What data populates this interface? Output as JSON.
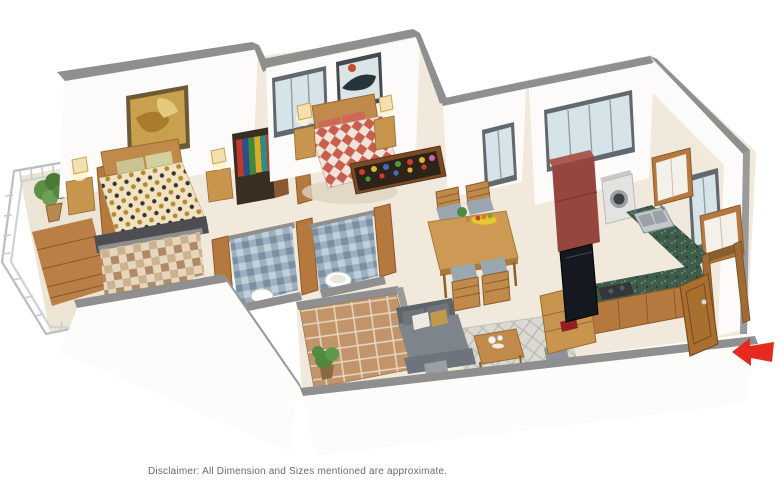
{
  "image": {
    "kind": "3d-isometric-floor-plan-render",
    "background": "#ffffff"
  },
  "disclaimer": {
    "text": "Disclaimer: All Dimension and Sizes mentioned are approximate."
  },
  "entrance_arrow": {
    "direction": "left",
    "color": "#e62b1e"
  },
  "palette": {
    "wall_cap": "#8f8f8f",
    "wall_face": "#fcfbf9",
    "floor": "#f1eadc",
    "wood": "#b5793f",
    "wood_light": "#c8954f",
    "granite_green": "#3f5c4b",
    "fridge_maroon": "#96463e",
    "sofa_gray": "#7e848c",
    "tile_blue": "#8ea2b5",
    "tile_brown": "#b08a64",
    "balcony_tile": "#c2946a",
    "window_glass": "#d6e4e9",
    "duvet_gold": "#b68a2c",
    "duvet_red": "#c75f4e"
  },
  "rooms": [
    {
      "id": "bedroom-1",
      "label": "Bedroom",
      "items": [
        "double bed",
        "2 nightstands",
        "2 table lamps",
        "wall art",
        "open wardrobe with clothes",
        "balcony door"
      ]
    },
    {
      "id": "master-bedroom",
      "label": "Master Bedroom",
      "items": [
        "double bed",
        "2 nightstands",
        "2 table lamps",
        "wall art",
        "window",
        "display shelf with bottles"
      ]
    },
    {
      "id": "balcony-left",
      "label": "Balcony",
      "items": [
        "metal railing",
        "potted plant",
        "wooden deck"
      ]
    },
    {
      "id": "bathroom-1",
      "label": "Bathroom",
      "items": [
        "brown checker tiled wall",
        "toilet",
        "wooden door"
      ]
    },
    {
      "id": "bathroom-2",
      "label": "Bathroom",
      "items": [
        "blue checker tiled wall",
        "toilet",
        "wooden door"
      ]
    },
    {
      "id": "bathroom-3",
      "label": "Bathroom",
      "items": [
        "blue checker tiled wall",
        "toilet",
        "wooden door"
      ]
    },
    {
      "id": "dining-area",
      "label": "Dining",
      "items": [
        "wooden dining table",
        "4 chairs",
        "fruit platter"
      ]
    },
    {
      "id": "kitchen",
      "label": "Kitchen",
      "items": [
        "refrigerator",
        "washing machine",
        "granite L-counter",
        "sink",
        "cooktop",
        "2 wall cabinets",
        "window"
      ]
    },
    {
      "id": "living-room",
      "label": "Living Room",
      "items": [
        "grey sofa",
        "cushions",
        "patterned rug",
        "coffee table",
        "2 poufs",
        "TV unit",
        "television"
      ]
    },
    {
      "id": "balcony-bottom",
      "label": "Balcony",
      "items": [
        "terracotta floor tiles",
        "potted plant"
      ]
    },
    {
      "id": "entrance",
      "label": "Entrance",
      "items": [
        "wooden door",
        "door frame",
        "red direction arrow"
      ]
    }
  ]
}
